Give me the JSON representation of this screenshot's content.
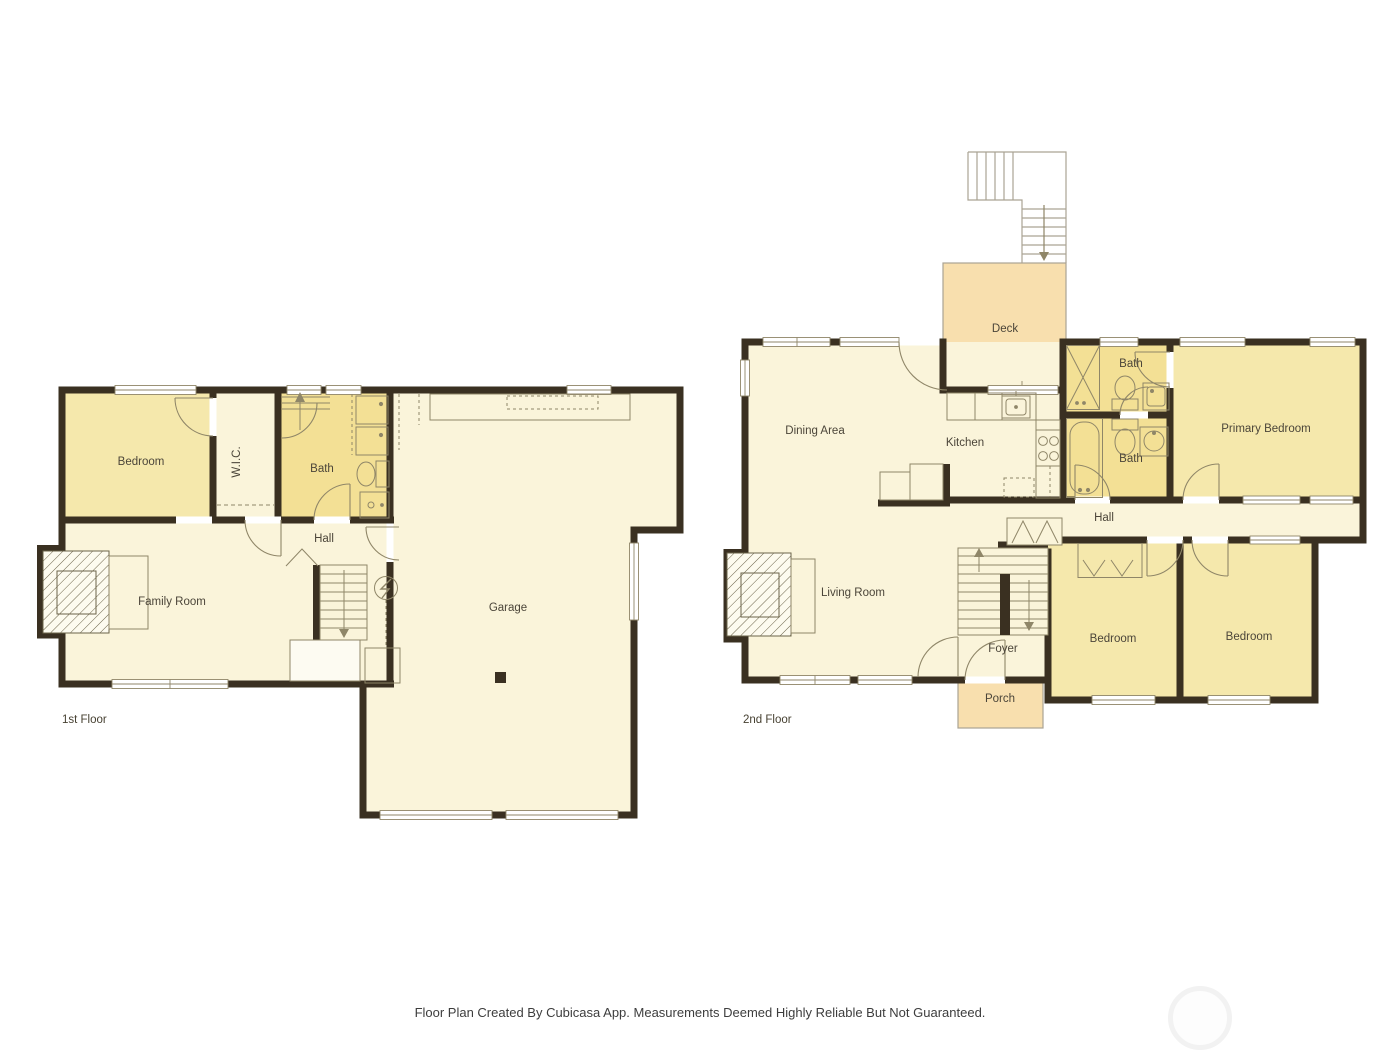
{
  "first_floor": {
    "label": "1st Floor",
    "bedroom": "Bedroom",
    "wic": "W.I.C.",
    "bath": "Bath",
    "hall": "Hall",
    "family_room": "Family Room",
    "garage": "Garage"
  },
  "second_floor": {
    "label": "2nd Floor",
    "deck": "Deck",
    "dining_area": "Dining Area",
    "kitchen": "Kitchen",
    "bath_upper": "Bath",
    "bath_lower": "Bath",
    "primary_bedroom": "Primary Bedroom",
    "hall": "Hall",
    "living_room": "Living Room",
    "foyer": "Foyer",
    "porch": "Porch",
    "bedroom_left": "Bedroom",
    "bedroom_right": "Bedroom"
  },
  "footer": {
    "disclaimer": "Floor Plan Created By Cubicasa App. Measurements Deemed Highly Reliable But Not Guaranteed."
  },
  "colors": {
    "wall": "#3a3021",
    "room_cream": "#faf4da",
    "room_yellow": "#f5e8ac",
    "bath_yellow": "#f3e095",
    "outdoor_peach": "#f8dfae",
    "fixture_line": "#8f8668",
    "label_text": "#4b4539"
  }
}
